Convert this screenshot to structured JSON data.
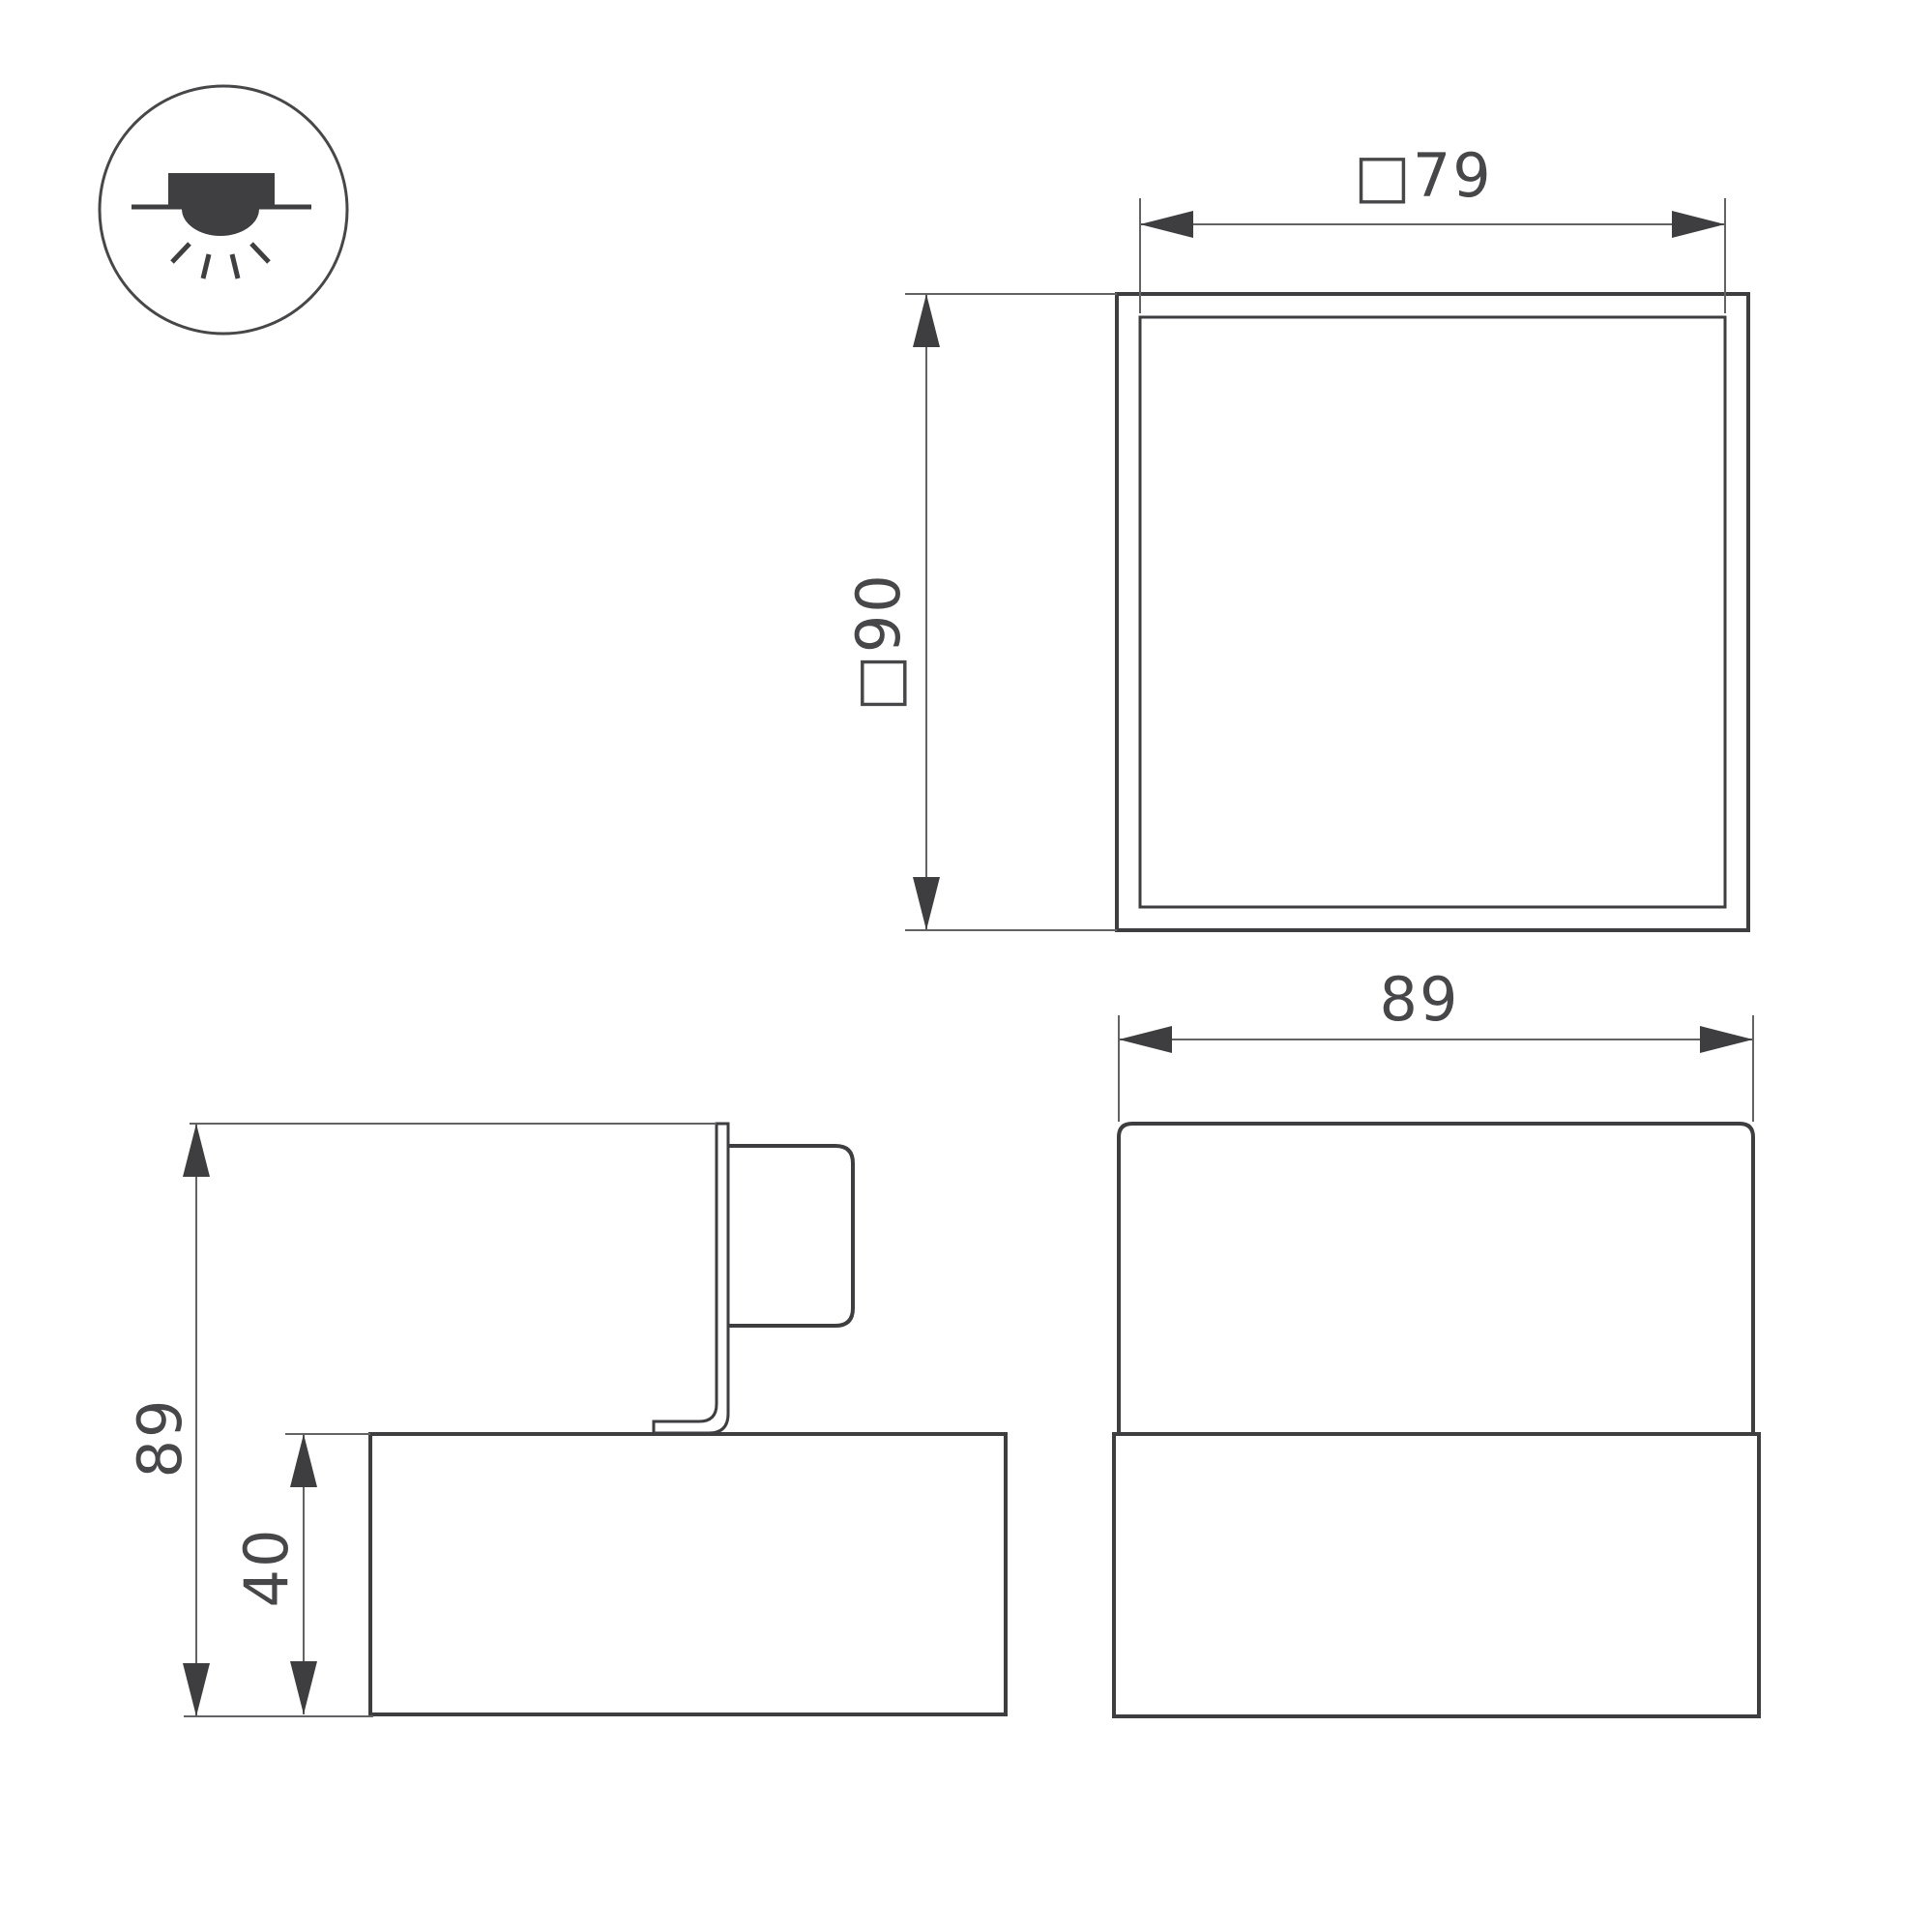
{
  "colors": {
    "background": "#ffffff",
    "object_line": "#3e3e40",
    "dimension_line": "#636366",
    "arrow": "#3e3e40",
    "text": "#47474a",
    "icon_fill": "#3f3f41"
  },
  "icon": {
    "name": "surface-mounted-downlight-symbol"
  },
  "dimensions": {
    "top_view": {
      "width": "□79",
      "height": "□90"
    },
    "side_view": {
      "overall_height": "89",
      "base_height": "40"
    },
    "front_view": {
      "width": "89"
    }
  }
}
